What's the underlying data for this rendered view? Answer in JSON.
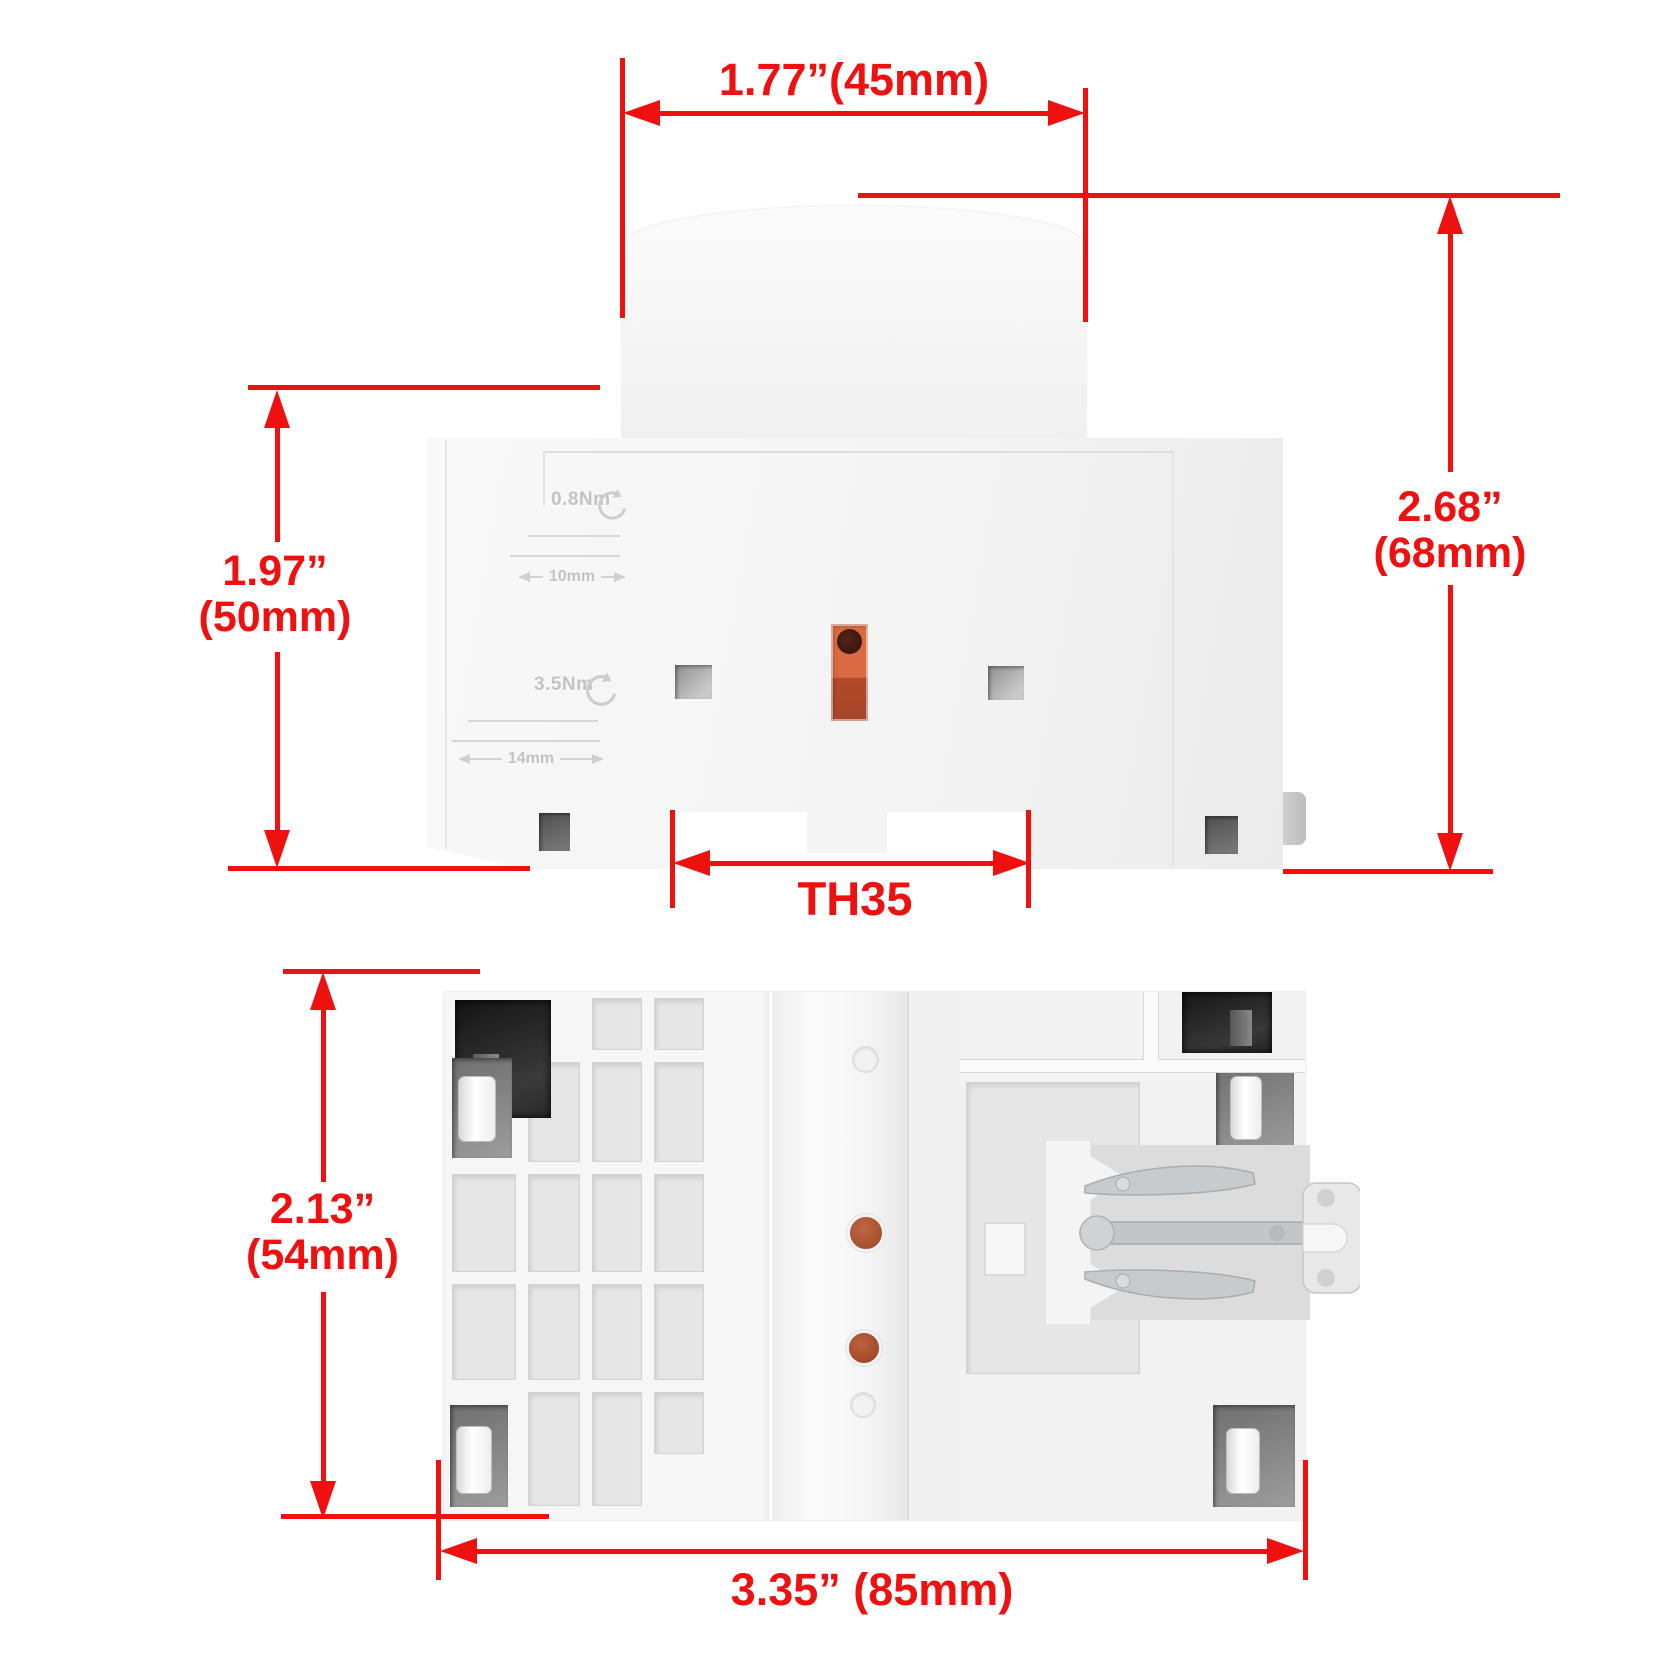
{
  "image_type": "product dimension diagram of a DIN-rail modular contactor (two photo views with red measurement annotations)",
  "colors": {
    "annotation_red": "#ef1010",
    "device_white": "#f5f5f5",
    "orange_slot": "#cd5c35",
    "clip_gray": "#c7cbcd"
  },
  "top_view": {
    "dims": {
      "width_top": "1.77”(45mm)",
      "height_right": [
        "2.68”",
        "(68mm)"
      ],
      "height_left": [
        "1.97”",
        "(50mm)"
      ],
      "din_rail": "TH35"
    },
    "engravings": {
      "torque_upper": "0.8Nm",
      "gauge_upper": "10mm",
      "torque_lower": "3.5Nm",
      "gauge_lower": "14mm"
    }
  },
  "bottom_view": {
    "dims": {
      "height_left": [
        "2.13”",
        "(54mm)"
      ],
      "width_bottom": "3.35” (85mm)"
    }
  }
}
